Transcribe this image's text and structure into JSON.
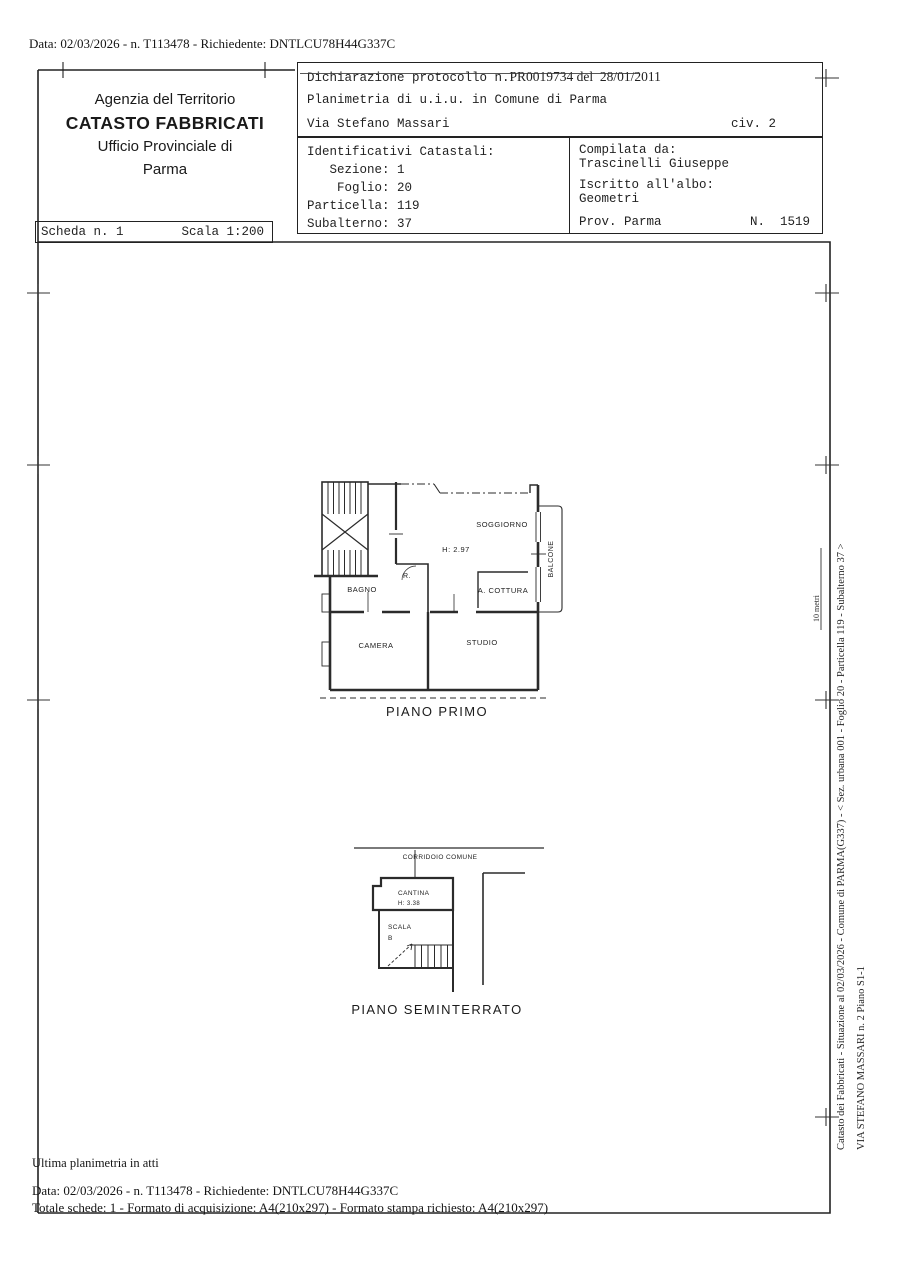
{
  "page": {
    "top_line": "Data: 02/03/2026 - n. T113478 - Richiedente: DNTLCU78H44G337C"
  },
  "agency": {
    "line1": "Agenzia del Territorio",
    "line2": "CATASTO FABBRICATI",
    "line3": "Ufficio Provinciale di",
    "line4": "Parma"
  },
  "scheda": {
    "number": "Scheda n. 1",
    "scale": "Scala 1:200"
  },
  "declaration": {
    "protocol_label": "Dichiarazione protocollo n.",
    "protocol_value": "PR0019734 del  28/01/2011",
    "planimetria": "Planimetria di u.i.u. in Comune di Parma",
    "street": "Via Stefano Massari",
    "civic": "civ. 2"
  },
  "identifiers": {
    "title": "Identificativi Catastali:",
    "rows": [
      "   Sezione: 1",
      "    Foglio: 20",
      "Particella: 119",
      "Subalterno: 37"
    ]
  },
  "compiler": {
    "label": "Compilata da:",
    "name": "Trascinelli Giuseppe",
    "albo_label": "Iscritto all'albo:",
    "albo_value": "Geometri",
    "province": "Prov. Parma",
    "number": "N.  1519"
  },
  "plan_first": {
    "caption": "PIANO PRIMO",
    "soggiorno": "SOGGIORNO",
    "height": "H: 2.97",
    "ripostiglio": "R.",
    "bagno": "BAGNO",
    "cottura": "A. COTTURA",
    "camera": "CAMERA",
    "studio": "STUDIO",
    "balcone": "BALCONE"
  },
  "plan_basement": {
    "caption": "PIANO SEMINTERRATO",
    "corridoio": "CORRIDOIO COMUNE",
    "cantina": "CANTINA",
    "height": "H: 3.38",
    "scala": "SCALA",
    "scala_letter": "B"
  },
  "sidebar": {
    "line1": "Catasto dei Fabbricati - Situazione al 02/03/2026 - Comune di PARMA(G337) - < Sez. urbana 001 - Foglio 20 - Particella 119 - Subalterno 37 >",
    "line2": "VIA STEFANO MASSARI n. 2 Piano S1-1",
    "scale_mark": "10 metri"
  },
  "footer": {
    "note": "Ultima planimetria in atti",
    "line1": "Data: 02/03/2026 - n. T113478 - Richiedente: DNTLCU78H44G337C",
    "line2": "Totale schede: 1 - Formato di acquisizione: A4(210x297)  - Formato stampa richiesto: A4(210x297)"
  }
}
